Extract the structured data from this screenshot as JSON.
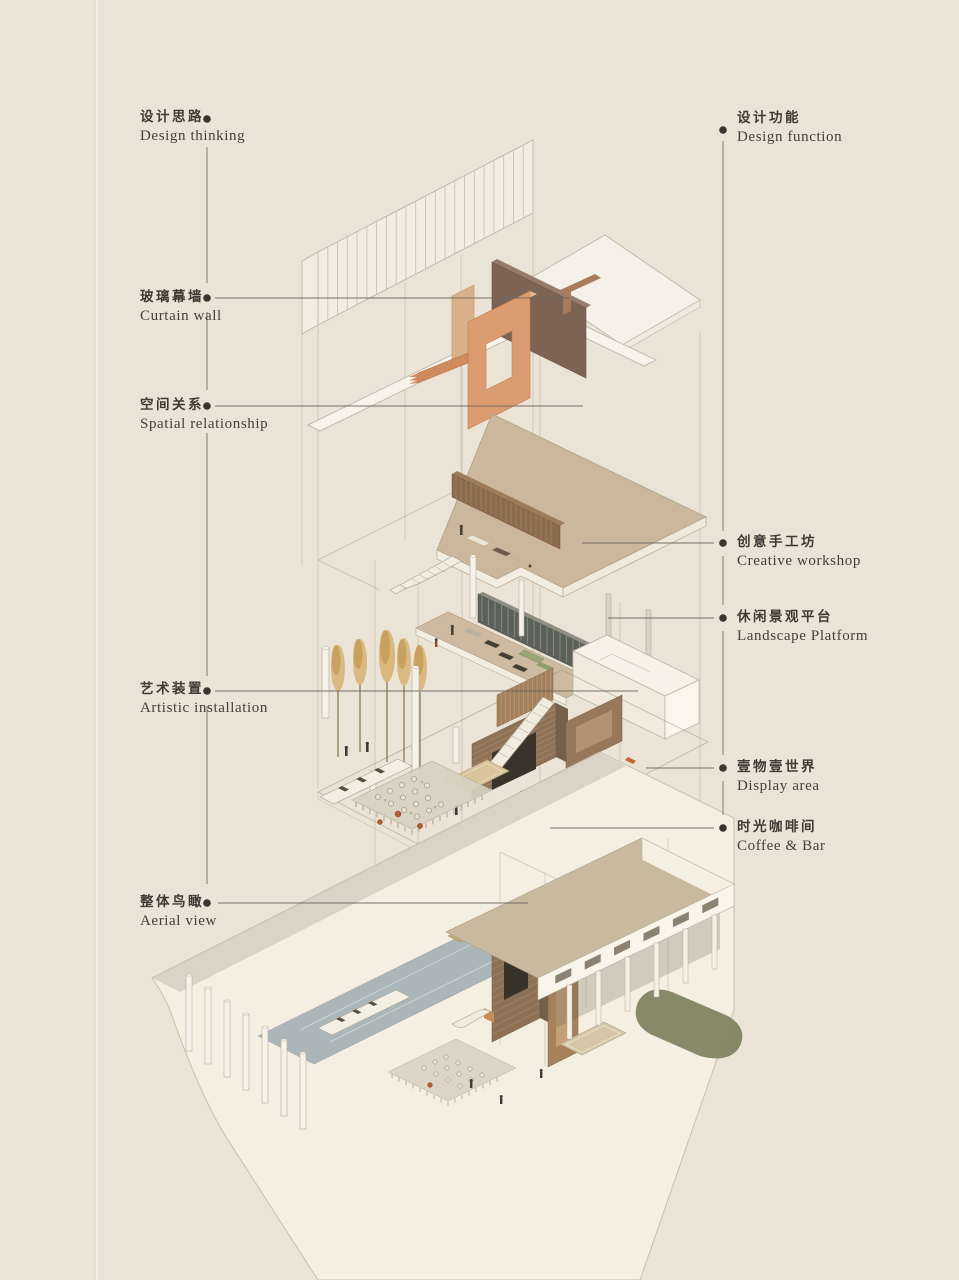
{
  "labels": {
    "left": [
      {
        "id": "design-thinking",
        "zh": "设计思路",
        "en": "Design thinking"
      },
      {
        "id": "curtain-wall",
        "zh": "玻璃幕墙",
        "en": "Curtain wall"
      },
      {
        "id": "spatial-relationship",
        "zh": "空间关系",
        "en": "Spatial relationship"
      },
      {
        "id": "artistic-installation",
        "zh": "艺术装置",
        "en": "Artistic installation"
      },
      {
        "id": "aerial-view",
        "zh": "整体鸟瞰",
        "en": "Aerial view"
      }
    ],
    "right": [
      {
        "id": "design-function",
        "zh": "设计功能",
        "en": "Design function"
      },
      {
        "id": "creative-workshop",
        "zh": "创意手工坊",
        "en": "Creative workshop"
      },
      {
        "id": "landscape-platform",
        "zh": "休闲景观平台",
        "en": "Landscape Platform"
      },
      {
        "id": "display-area",
        "zh": "壹物壹世界",
        "en": "Display area"
      },
      {
        "id": "coffee-bar",
        "zh": "时光咖啡间",
        "en": "Coffee & Bar"
      }
    ]
  },
  "palette": {
    "background": "#ebe3d5",
    "paper_line": "#f6f1e8",
    "text": "#3f3b34",
    "leader_line": "#6a645a",
    "leader_dot": "#3a362f",
    "ground_plane": "#f5efe2",
    "tan_floor": "#cbb79b",
    "wood_slat": "#8d7258",
    "sculpture_orange": "#dc9c72",
    "sculpture_dark": "#7d6353",
    "panel_dark": "#5d6056",
    "pool_blue": "#a4b0b4",
    "landscape_green": "#7f8461",
    "tree_tan": "#d7b173"
  }
}
